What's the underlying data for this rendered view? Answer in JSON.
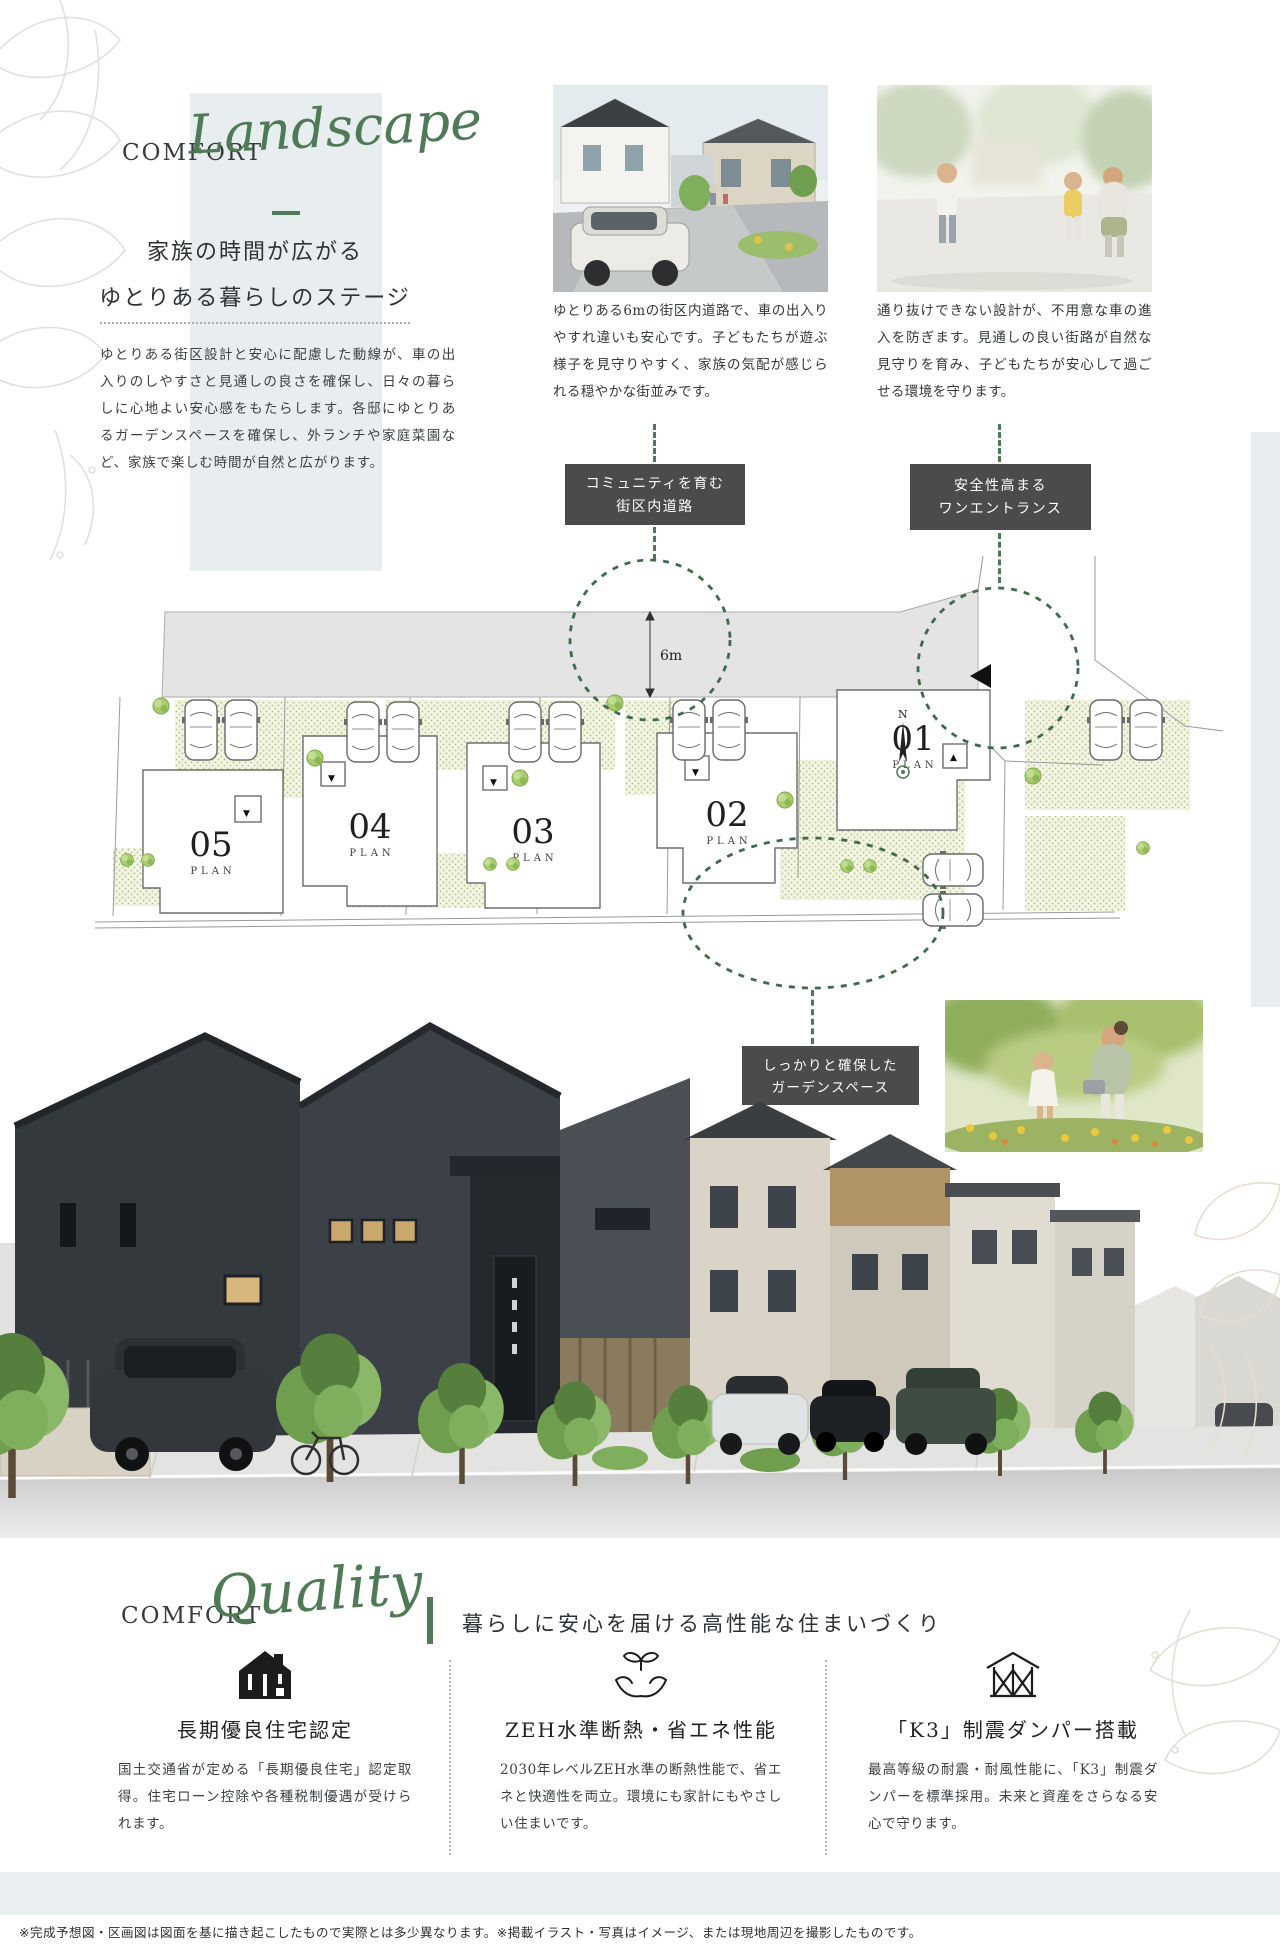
{
  "landscape": {
    "eyebrow": "COMFORT",
    "script": "Landscape",
    "title_line1": "家族の時間が広がる",
    "title_line2": "ゆとりある暮らしのステージ",
    "body": "ゆとりある街区設計と安心に配慮した動線が、車の出入りのしやすさと見通しの良さを確保し、日々の暮らしに心地よい安心感をもたらします。各邸にゆとりあるガーデンスペースを確保し、外ランチや家庭菜園など、家族で楽しむ時間が自然と広がります。",
    "photos": [
      {
        "caption": "ゆとりある6mの街区内道路で、車の出入りやすれ違いも安心です。子どもたちが遊ぶ様子を見守りやすく、家族の気配が感じられる穏やかな街並みです。"
      },
      {
        "caption": "通り抜けできない設計が、不用意な車の進入を防ぎます。見通しの良い街路が自然な見守りを育み、子どもたちが安心して過ごせる環境を守ります。"
      }
    ],
    "callouts": {
      "road": {
        "line1": "コミュニティを育む",
        "line2": "街区内道路"
      },
      "entrance": {
        "line1": "安全性高まる",
        "line2": "ワンエントランス"
      },
      "garden": {
        "line1": "しっかりと確保した",
        "line2": "ガーデンスペース"
      }
    }
  },
  "siteplan": {
    "road_width": "6m",
    "plan_word": "PLAN",
    "compass": "N",
    "plots": [
      {
        "no": "01"
      },
      {
        "no": "02"
      },
      {
        "no": "03"
      },
      {
        "no": "04"
      },
      {
        "no": "05"
      }
    ]
  },
  "quality": {
    "eyebrow": "COMFORT",
    "script": "Quality",
    "heading": "暮らしに安心を届ける高性能な住まいづくり",
    "features": [
      {
        "icon": "certified-house-icon",
        "title": "長期優良住宅認定",
        "body": "国土交通省が定める「長期優良住宅」認定取得。住宅ローン控除や各種税制優遇が受けられます。"
      },
      {
        "icon": "hands-leaf-icon",
        "title": "ZEH水準断熱・省エネ性能",
        "body": "2030年レベルZEH水準の断熱性能で、省エネと快適性を両立。環境にも家計にもやさしい住まいです。"
      },
      {
        "icon": "damper-frame-icon",
        "title": "「K3」制震ダンパー搭載",
        "body": "最高等級の耐震・耐風性能に、「K3」制震ダンパーを標準採用。未来と資産をさらなる安心で守ります。"
      }
    ]
  },
  "footer": {
    "note": "※完成予想図・区画図は図面を基に描き起こしたもので実際とは多少異なります。※掲載イラスト・写真はイメージ、または現地周辺を撮影したものです。"
  },
  "colors": {
    "accent_green": "#4e7a55",
    "circle_green": "#3e6b4c",
    "callout_bg": "#4b4b4b",
    "pale_band": "#e8eef0",
    "garden_dot": "#bfca8c"
  }
}
